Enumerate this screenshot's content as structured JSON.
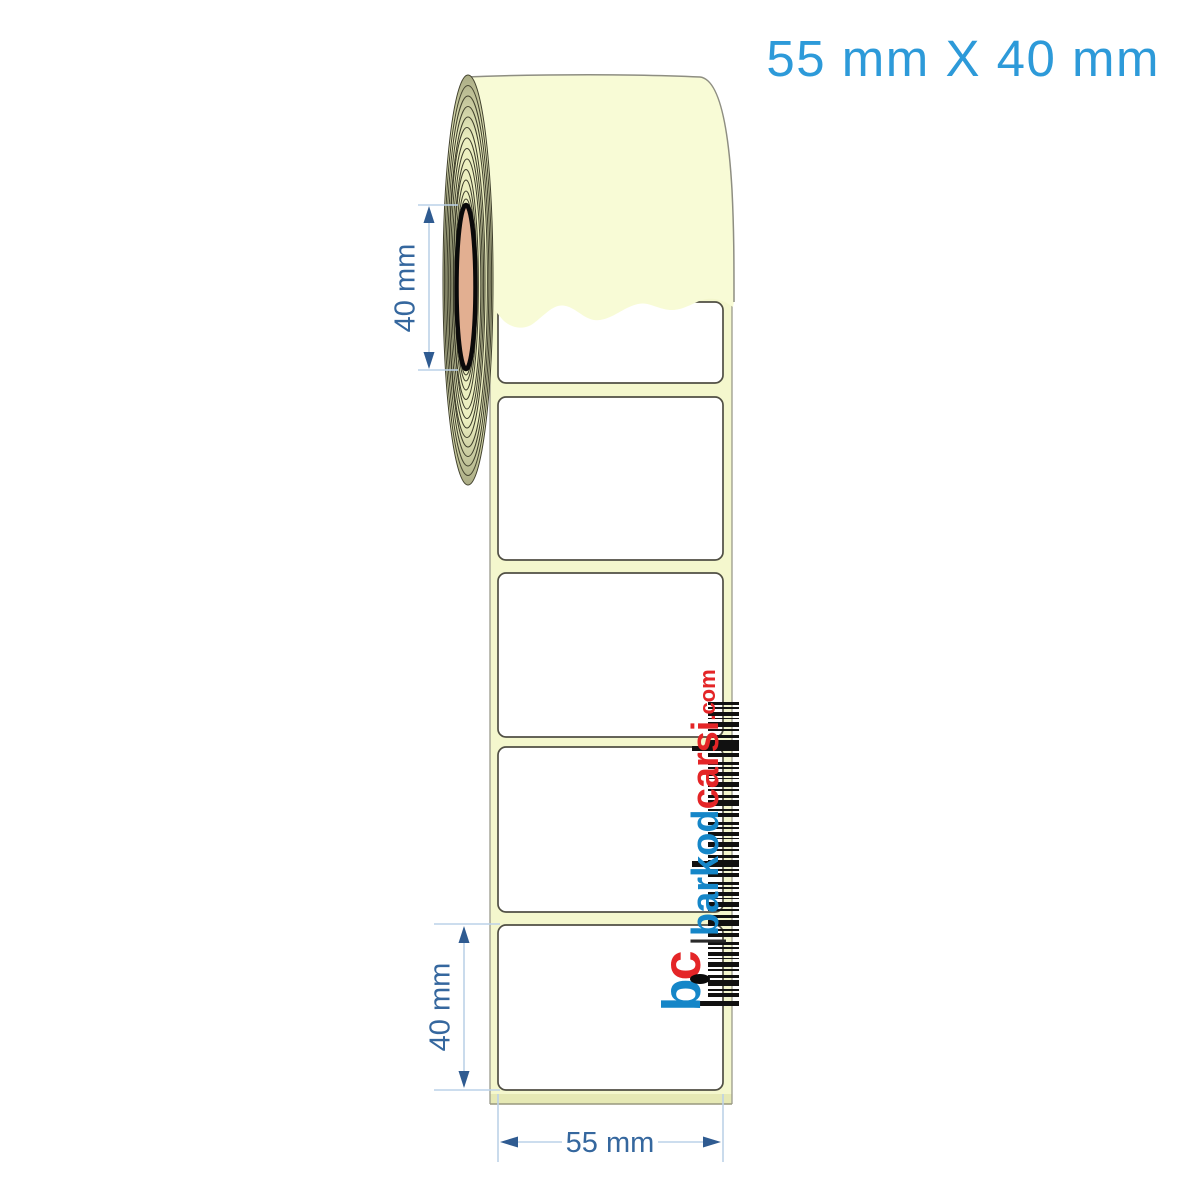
{
  "title": "55 mm X 40 mm",
  "product": {
    "type": "blank thermal label roll",
    "visible_label_count": 5
  },
  "dimensions": {
    "core_height": "40 mm",
    "label_height": "40 mm",
    "label_width": "55 mm"
  },
  "watermark": {
    "monogram_b": "b",
    "monogram_c": "c",
    "separator": "|",
    "brand_part1": "barkod",
    "brand_part2": "carsi",
    "tld": ".com"
  },
  "colors": {
    "title_blue": "#2D9AD9",
    "dimension_text_blue": "#35679E",
    "dimension_arrow_blue": "#2F5B91",
    "dimension_line_blue": "#BCD2E8",
    "roll_cream": "#F8FBD6",
    "strip_cream": "#F4F7CD",
    "windings_cream": "#ECEFC0",
    "core_salmon": "#E2AF91",
    "label_white": "#FFFFFF",
    "logo_blue": "#1586C8",
    "logo_red": "#E42527",
    "barcode_black": "#111111"
  }
}
